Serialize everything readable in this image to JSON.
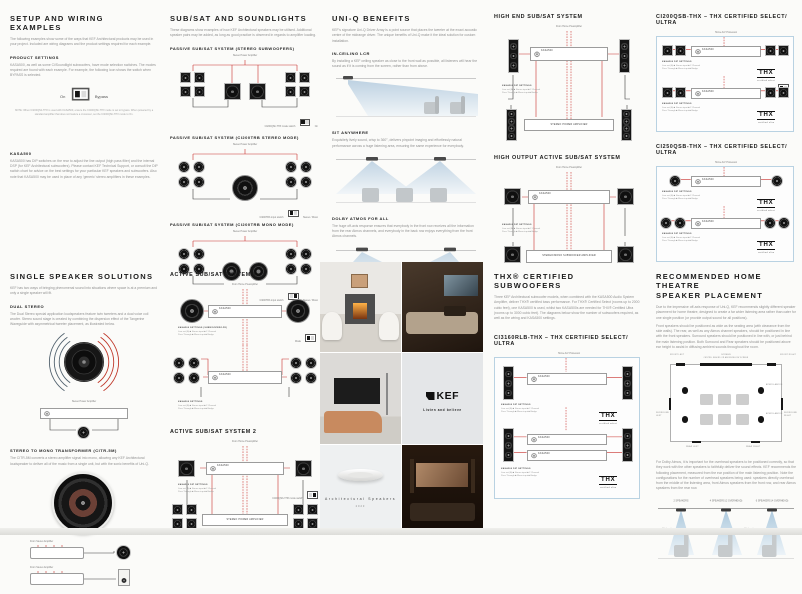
{
  "labels": {
    "stereo_power_amplifier": "Stereo Power Amplifier",
    "from_home_preamplifier": "From Home Preamplifier",
    "from_stereo_amplifier": "From Stereo Amplifier",
    "home_av_processor": "Home A/V Processor",
    "kasa500": "KASA500",
    "on": "On",
    "bypass": "Bypass",
    "mode": "Mode",
    "x2": "2x",
    "thx": "THX",
    "thx_select": "certified select",
    "thx_ultra": "certified ultra",
    "dip_title": "KASA500 DIP SETTINGS",
    "dip_line1": "Line out (A) ■ Stereo input ■ 2 Channel",
    "dip_line2": "Pass Through ■ Mono input ■ Bridge",
    "stereo_mono": "Stereo / Mono"
  },
  "col1_top": {
    "heading": "SETUP AND WIRING EXAMPLES",
    "intro": "The following examples show some of the ways that KEF Architectural products may be used in your project. Included are wiring diagrams and the product settings required for each example.",
    "product_settings": {
      "heading": "PRODUCT SETTINGS",
      "body": "KASA500, as well as some Ci/Soundlight subwoofers, have mode selection switches. The modes required are found with each example. For example, the following icon shows the switch when BYPASS is selected.",
      "switch_on": "On",
      "switch_bypass": "Bypass",
      "note": "NOTE: When CI200QSb-THX is used with KASA500, ensure the CI200QSb-THX mode is set to bypass. When powered by a standard amplifier that does not feature a crossover, set the CI200QSb-THX mode to On."
    },
    "kasa500": {
      "heading": "KASA500",
      "body": "KASA500 has DIP switches on the rear to adjust the line output (high pass filter) and the internal DSP (for KEF Architectural subwoofers). Please contact KEF Technical Support, or consult the DIP switch chart for advice on the best settings for your particular KEF speakers and subwoofers. Also note that KASA500 may be used in place of any 'generic' stereo amplifiers in these examples."
    }
  },
  "col2_top": {
    "heading": "SUB/SAT AND SOUNDLIGHTS",
    "intro": "These diagrams show examples of how KEF Architectural speakers may be utilised. Additional speaker pairs may be added, as long as good practice is observed in regards to amplifier loading.",
    "d1_label": "PASSIVE SUB/SAT SYSTEM (STEREO SUBWOOFERS)",
    "d1_caption": "CI200QSb-THX mode switch",
    "d2_label": "PASSIVE SUB/SAT SYSTEM (CI200TRB STEREO MODE)",
    "d2_caption": "CI200TRb input switch",
    "d3_label": "PASSIVE SUB/SAT SYSTEM (CI200TRB MONO MODE)",
    "d3_caption": "CI200TRb input switch"
  },
  "col3_top": {
    "heading": "UNI-Q BENEFITS",
    "intro": "KEF's signature Uni-Q Driver Array is a point source that places the tweeter at the exact acoustic centre of the midrange driver. The unique benefits of Uni-Q make it the ideal solution for custom installation.",
    "lcr_heading": "IN-CEILING LCR",
    "lcr_body": "By installing a KEF ceiling speaker as close to the front wall as possible, all listeners will hear the sound as if it is coming from the screen, rather than from above.",
    "sit_heading": "SIT ANYWHERE",
    "sit_body": "Exquisitely lively sound, crisp to 360°, delivers pinpoint imaging and effortlessly natural performance across a huge listening area, ensuring the same experience for everybody.",
    "atmos_heading": "DOLBY ATMOS FOR ALL",
    "atmos_body": "The huge off-axis response ensures that everybody in the front row receives all the information from the rear Atmos channels, and everybody in the back row enjoys everything from the front Atmos channels."
  },
  "col4_top": {
    "s1_heading": "HIGH END SUB/SAT SYSTEM",
    "s2_heading": "HIGH OUTPUT ACTIVE SUB/SAT SYSTEM",
    "amp2_label": "STEREO POWER AMPLIFIER",
    "amp3_label": "STEREO/MONO SUBWOOFER AMPLIFIER"
  },
  "col5_top": {
    "s1_heading": "CI200QSB-THX  –  THX CERTIFIED SELECT/ ULTRA",
    "s2_heading": "CI250QSB-THX  –  THX CERTIFIED SELECT/ ULTRA"
  },
  "col1_bottom": {
    "heading": "SINGLE SPEAKER SOLUTIONS",
    "intro": "KEF has two ways of bringing phenomenal sound into situations where space is at a premium and only a single speaker will fit.",
    "dual_heading": "DUAL STEREO",
    "dual_body": "The Dual Stereo special application loudspeakers feature twin tweeters and a dual voice coil woofer. Stereo sound stage is created by combining the dispersion effect of the Tangerine Waveguide with asymmetrical tweeter placement, as illustrated below.",
    "mono_heading": "STEREO TO MONO TRANSFORMER (CITR-5M)",
    "mono_body": "The CITR-5M converts a stereo amplifier signal into mono, allowing any KEF Architectural loudspeaker to deliver all of the music from a single unit, but with the sonic benefits of Uni-Q."
  },
  "col2_bottom": {
    "s1_heading": "ACTIVE SUB/SAT SYSTEM 1",
    "s2_heading": "ACTIVE SUB/SAT SYSTEM 2",
    "capA": "KASA500 SETTINGS (SUBWOOFER/LFE)",
    "capB": "KASA500 SETTINGS",
    "capC": "CI200QSb-THX mode switch",
    "amp2_label": "STEREO POWER AMPLIFIER"
  },
  "collage": {
    "brand": "KEF",
    "tagline": "Listen and believe",
    "caption": "Architectural Speakers",
    "year": "2023"
  },
  "col4_bottom": {
    "heading": "THX® CERTIFIED SUBWOOFERS",
    "intro": "Three KEF Architectural subwoofer models, when combined with the KASA500 Audio System Amplifier, deliver THX® certified bass performance. For THX® Certified Select (rooms up to 2000 cubic feet), one KASA500 is used, whilst two KASA500s are needed for THX® Certified Ultra (rooms up to 3000 cubic feet). The diagrams below show the number of subwoofers required, as well as the wiring and KASA500 settings.",
    "subheading": "CI3160RLB-THX  –  THX CERTIFIED SELECT/ ULTRA"
  },
  "col5_bottom": {
    "heading1": "RECOMMENDED HOME THEATRE",
    "heading2": "SPEAKER PLACEMENT",
    "p1": "Due to the impressive off-axis response of Uni-Q, KEF recommends slightly different speaker placement for home theatre, designed to create a far wider listening area rather than cater for one single position (or provide output sound for all positions).",
    "p2": "Front speakers should be positioned as wide as the seating area (with clearance from the side walls). The rear, as well as any Atmos channel speakers, should be positioned in line with the front speakers. Surround speakers should be positioned in line with, or just behind the main listening position. Both Surround and Rear speakers should be positioned above ear height to assist in diffusing ambient sounds throughout the room.",
    "p3": "For Dolby Atmos, it is important for the overhead speakers to be positioned correctly, so that they work with the other speakers to faithfully deliver the sound effects. KEF recommends the following placement, measured from the ear position of the main listening position. Note the configurations for the number of overhead speakers being used: speakers directly overhead from the middle of the listening area, front Atmos speakers from the front row, and rear Atmos speakers from the rear row.",
    "room": {
      "front_left": "FRONT LEFT",
      "screen": "SCREEN",
      "centre": "CENTRE: BEHIND OR ABOVE/BELOW SCREEN",
      "front_right": "FRONT RIGHT",
      "surround_left": "SURROUND LEFT",
      "surround_right": "SURROUND RIGHT",
      "rear_left": "REAR LEFT",
      "rear_right": "REAR RIGHT",
      "atmos": "ATMOS ABOVE"
    },
    "side": {
      "l1": "2 SPEAKERS",
      "l2": "4 SPEAKERS (2 OVERHEAD)",
      "l3": "6 SPEAKERS (4 OVERHEAD)",
      "a1": "65° (max)",
      "a2": "45° (max)"
    }
  }
}
